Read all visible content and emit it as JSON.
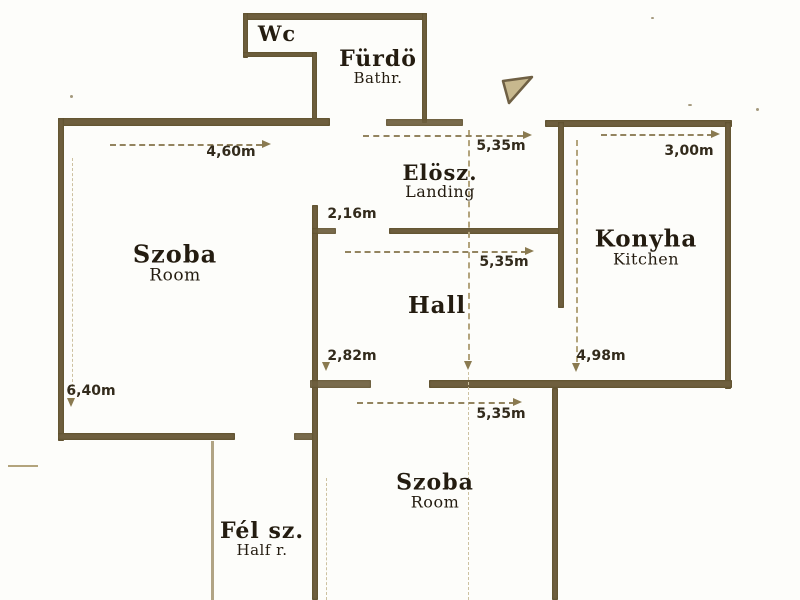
{
  "document": {
    "type": "floor-plan-scan"
  },
  "colors": {
    "paper": "#fdfdfa",
    "wall": "#6e5f3e",
    "label_ink": "#241c10",
    "dimension_ink": "#332b1c",
    "faint_line": "#b3a47c",
    "north_arrow_fill": "#c7b88e"
  },
  "icons": {
    "north_arrow": "pennant-arrow"
  },
  "rooms": [
    {
      "id": "wc",
      "name": "Wc",
      "sub": ""
    },
    {
      "id": "bathroom",
      "name": "Fürdö",
      "sub": "Bathr."
    },
    {
      "id": "landing",
      "name": "Elösz.",
      "sub": "Landing"
    },
    {
      "id": "room-left",
      "name": "Szoba",
      "sub": "Room"
    },
    {
      "id": "kitchen",
      "name": "Konyha",
      "sub": "Kitchen"
    },
    {
      "id": "hall",
      "name": "Hall",
      "sub": ""
    },
    {
      "id": "room-bottom",
      "name": "Szoba",
      "sub": "Room"
    },
    {
      "id": "half-room",
      "name": "Fél sz.",
      "sub": "Half r."
    }
  ],
  "dimensions": [
    {
      "id": "room-left-width",
      "text": "4,60m"
    },
    {
      "id": "landing-width",
      "text": "5,35m"
    },
    {
      "id": "kitchen-width",
      "text": "3,00m"
    },
    {
      "id": "landing-depth",
      "text": "2,16m"
    },
    {
      "id": "hall-width",
      "text": "5,35m"
    },
    {
      "id": "hall-depth",
      "text": "2,82m"
    },
    {
      "id": "kitchen-depth",
      "text": "4,98m"
    },
    {
      "id": "room-bottom-width",
      "text": "5,35m"
    },
    {
      "id": "room-left-depth",
      "text": "6,40m"
    }
  ]
}
